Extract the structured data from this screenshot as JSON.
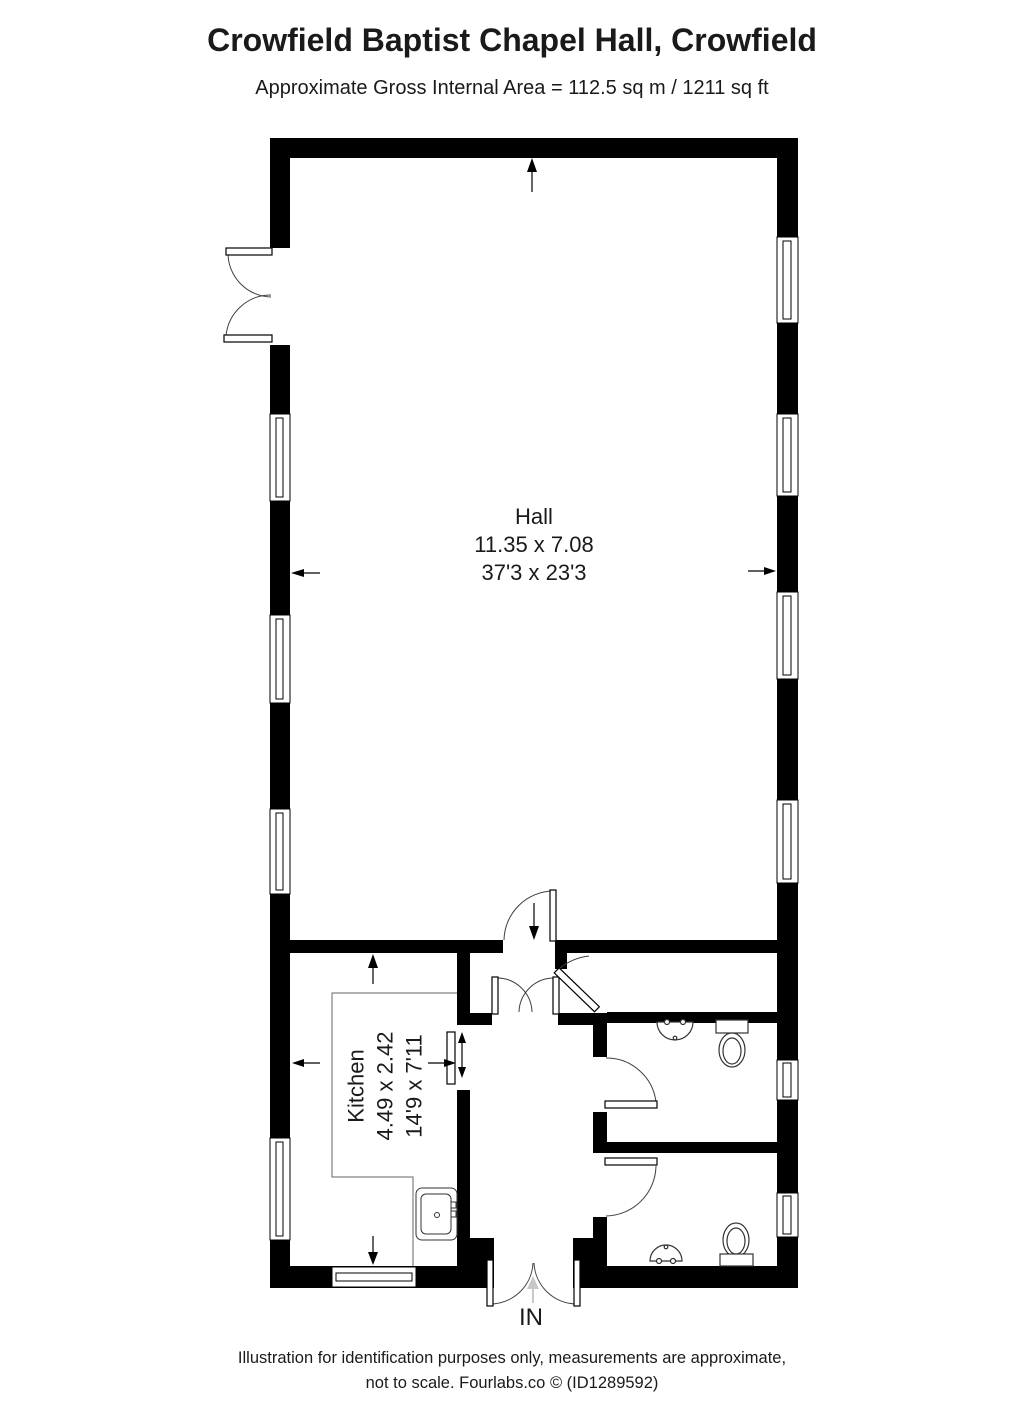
{
  "header": {
    "title": "Crowfield Baptist Chapel Hall, Crowfield",
    "subtitle": "Approximate Gross Internal Area = 112.5 sq m / 1211 sq ft"
  },
  "rooms": {
    "hall": {
      "name": "Hall",
      "dimensions_metric": "11.35 x 7.08",
      "dimensions_imperial": "37'3 x 23'3"
    },
    "kitchen": {
      "name": "Kitchen",
      "dimensions_metric": "4.49 x 2.42",
      "dimensions_imperial": "14'9 x 7'11"
    }
  },
  "entrance": {
    "label": "IN"
  },
  "footer": {
    "line1": "Illustration for identification purposes only, measurements are approximate,",
    "line2": "not to scale. Fourlabs.co © (ID1289592)"
  },
  "icons": {
    "fixtures": [
      "toilet-icon",
      "basin-icon",
      "kitchen-sink-icon",
      "serving-hatch",
      "window",
      "door-leaf",
      "door-swing-arc"
    ],
    "arrows": [
      "north-arrow",
      "dimension-arrow",
      "entry-direction-arrow"
    ]
  },
  "colors": {
    "wall": "#000000",
    "thin_line": "#3f3f3f",
    "fixture_line": "#333333",
    "counter_line": "#666666",
    "faint_arrow": "#c8c8c8",
    "text": "#1a1a1a",
    "background": "#ffffff"
  }
}
